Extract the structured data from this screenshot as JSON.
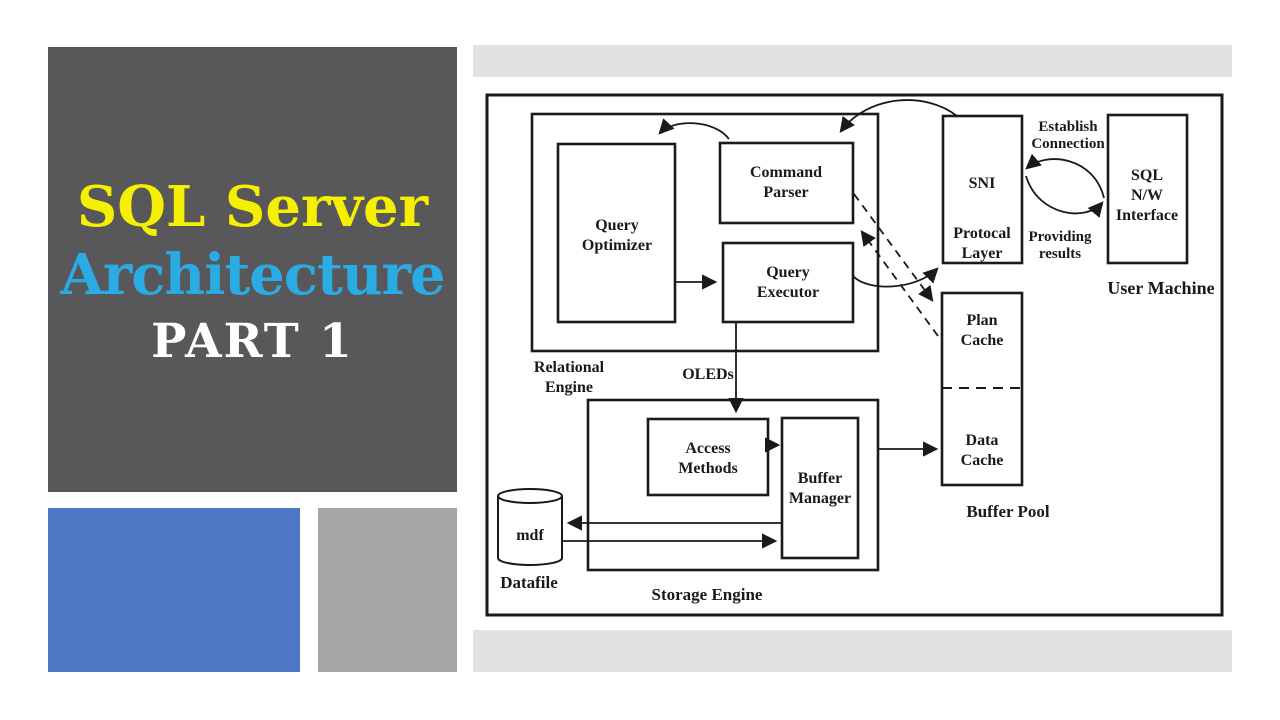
{
  "title_panel": {
    "line1": "SQL Server",
    "line2": "Architecture",
    "line3": "PART 1"
  },
  "diagram": {
    "relational_engine_label": [
      "Relational",
      "Engine"
    ],
    "query_optimizer": [
      "Query",
      "Optimizer"
    ],
    "command_parser": [
      "Command",
      "Parser"
    ],
    "query_executor": [
      "Query",
      "Executor"
    ],
    "sni": [
      "SNI",
      "Protocal",
      "Layer"
    ],
    "sql_nw_interface": [
      "SQL",
      "N/W",
      "Interface"
    ],
    "user_machine": "User Machine",
    "establish_connection": [
      "Establish",
      "Connection"
    ],
    "providing_results": [
      "Providing",
      "results"
    ],
    "plan_cache": [
      "Plan",
      "Cache"
    ],
    "data_cache": [
      "Data",
      "Cache"
    ],
    "buffer_pool_label": "Buffer Pool",
    "oleds_label": "OLEDs",
    "access_methods": [
      "Access",
      "Methods"
    ],
    "buffer_manager": [
      "Buffer",
      "Manager"
    ],
    "storage_engine_label": "Storage Engine",
    "mdf": "mdf",
    "datafile_label": "Datafile"
  },
  "colors": {
    "panel_bg": "#58585a",
    "title_yellow": "#f5ef00",
    "title_blue": "#2aabe4",
    "title_white": "#ffffff",
    "square_blue": "#4b77c4",
    "square_gray": "#a6a6a6",
    "bar_gray": "#e2e2e2",
    "line": "#1a1a1a",
    "page_bg": "#ffffff"
  }
}
